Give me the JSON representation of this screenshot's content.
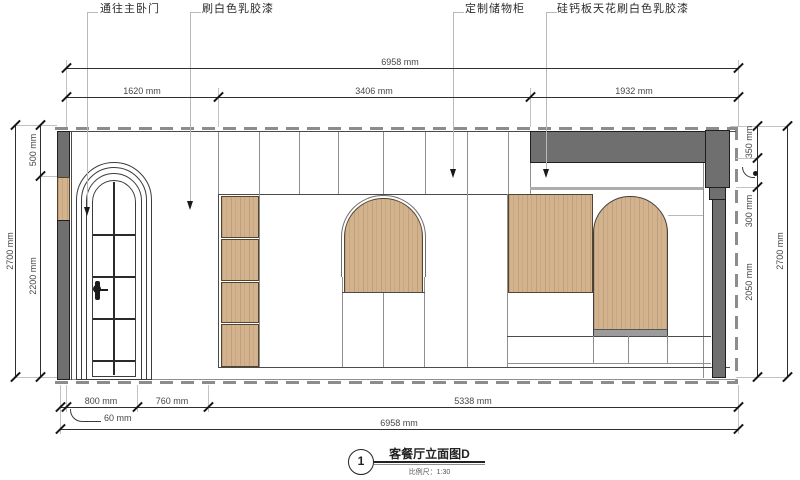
{
  "callouts": [
    {
      "text": "通往主卧门"
    },
    {
      "text": "刷白色乳胶漆"
    },
    {
      "text": "定制储物柜"
    },
    {
      "text": "硅钙板天花刷白色乳胶漆"
    }
  ],
  "dimensions": {
    "top": {
      "total": "6958 mm",
      "segments": [
        "1620 mm",
        "3406 mm",
        "1932 mm"
      ]
    },
    "left": {
      "total": "2700 mm",
      "segments": [
        "500 mm",
        "2200 mm"
      ]
    },
    "right": {
      "total": "2700 mm",
      "segments": [
        "350 mm",
        "300 mm",
        "2050 mm"
      ]
    },
    "bottom": {
      "total": "6958 mm",
      "segments": [
        "800 mm",
        "760 mm",
        "5338 mm"
      ],
      "offset": "60 mm"
    }
  },
  "title_block": {
    "number": "1",
    "title": "客餐厅立面图D",
    "scale_label": "比例尺：1:30"
  },
  "colors": {
    "wood": "#d3b38e",
    "structure_gray": "#6f6f6f",
    "line": "#2f2f2f",
    "leader_gray": "#c2c2c2"
  }
}
